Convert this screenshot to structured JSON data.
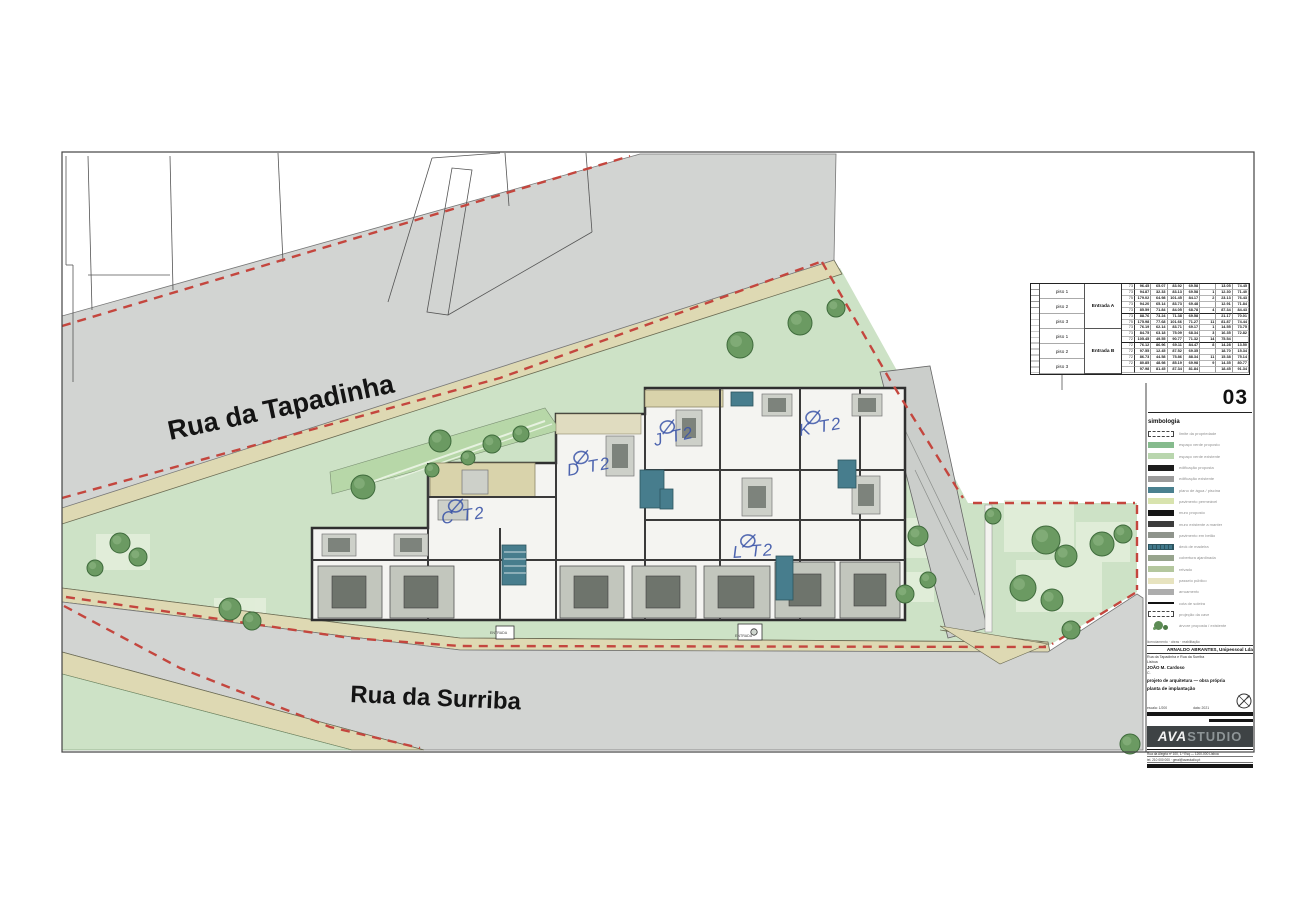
{
  "sheet": {
    "number": "03"
  },
  "streets": {
    "top": "Rua da Tapadinha",
    "bottom": "Rua da Surriba"
  },
  "plan": {
    "entrance_label": "ENTRADA",
    "unit_labels": [
      {
        "id": "C",
        "label": "C T2"
      },
      {
        "id": "D",
        "label": "D T2"
      },
      {
        "id": "J",
        "label": "J T2"
      },
      {
        "id": "K",
        "label": "K T2"
      },
      {
        "id": "L",
        "label": "L T2"
      }
    ]
  },
  "areas_table": {
    "row_labels": [
      "piso 1",
      "piso 2",
      "piso 3",
      "piso 1",
      "piso 2",
      "piso 3"
    ],
    "entrances": [
      "Entrada A",
      "Entrada B"
    ],
    "values": [
      [
        "73",
        "96.45",
        "65.07",
        "83.92",
        "69.58",
        "",
        "13.05",
        "74.45"
      ],
      [
        "73",
        "94.87",
        "32.33",
        "83.13",
        "69.58",
        "1",
        "12.30",
        "71.40"
      ],
      [
        "75",
        "179.02",
        "64.98",
        "101.45",
        "84.17",
        "2",
        "23.13",
        "76.43"
      ],
      [
        "73",
        "94.20",
        "65.14",
        "83.73",
        "69.48",
        "",
        "12.91",
        "71.84"
      ],
      [
        "73",
        "85.59",
        "71.84",
        "84.05",
        "68.78",
        "4",
        "87.34",
        "84.43"
      ],
      [
        "73",
        "88.76",
        "73.24",
        "71.38",
        "69.58",
        "",
        "21.17",
        "70.01"
      ],
      [
        "75",
        "175.98",
        "77.68",
        "101.66",
        "71.27",
        "11",
        "81.87",
        "74.44"
      ],
      [
        "73",
        "76.19",
        "62.14",
        "83.71",
        "69.17",
        "1",
        "14.55",
        "73.75"
      ],
      [
        "73",
        "84.75",
        "63.18",
        "75.09",
        "68.34",
        "3",
        "16.35",
        "72.82"
      ],
      [
        "72",
        "105.45",
        "49.55",
        "90.77",
        "71.32",
        "14",
        "75.54",
        ""
      ],
      [
        "72",
        "76.12",
        "86.96",
        "69.11",
        "84.47",
        "8",
        "14.28",
        "13.50"
      ],
      [
        "72",
        "97.55",
        "12.45",
        "87.52",
        "69.35",
        "",
        "18.70",
        "15.34"
      ],
      [
        "72",
        "86.73",
        "44.58",
        "75.86",
        "88.34",
        "11",
        "15.38",
        "75.14"
      ],
      [
        "72",
        "80.85",
        "48.98",
        "85.19",
        "69.98",
        "9",
        "14.35",
        "80.77"
      ],
      [
        "",
        "97.98",
        "81.45",
        "87.34",
        "81.84",
        "",
        "18.45",
        "91.34"
      ]
    ]
  },
  "legend": {
    "title": "simbologia",
    "items": [
      {
        "style": "dashed",
        "color": "#ffffff",
        "label": "limite da propriedade"
      },
      {
        "style": "solid",
        "color": "#86bb8d",
        "label": "espaço verde proposto"
      },
      {
        "style": "solid",
        "color": "#b9d6ae",
        "label": "espaço verde existente"
      },
      {
        "style": "solid",
        "color": "#1d1d1d",
        "label": "edificação proposta"
      },
      {
        "style": "solid",
        "color": "#9b9b9b",
        "label": "edificação existente"
      },
      {
        "style": "solid",
        "color": "#4a808f",
        "label": "plano de água / piscina"
      },
      {
        "style": "solid",
        "color": "#d8e3ae",
        "label": "pavimento permeável"
      },
      {
        "style": "solid",
        "color": "#161616",
        "label": "muro proposto"
      },
      {
        "style": "solid",
        "color": "#3c3c3c",
        "label": "muro existente a manter"
      },
      {
        "style": "solid",
        "color": "#8f948c",
        "label": "pavimento em betão"
      },
      {
        "style": "stripes",
        "color": "#41788a",
        "label": "deck de madeira"
      },
      {
        "style": "solid",
        "color": "#97a48d",
        "label": "cobertura ajardinada"
      },
      {
        "style": "solid",
        "color": "#b4c79e",
        "label": "relvado"
      },
      {
        "style": "solid",
        "color": "#e7e3bf",
        "label": "passeio público"
      },
      {
        "style": "solid",
        "color": "#adadad",
        "label": "arruamento"
      },
      {
        "style": "line",
        "color": "#111111",
        "label": "cota de soleira"
      },
      {
        "style": "dashed",
        "color": "#ffffff",
        "label": "projeção da cave"
      },
      {
        "style": "tree",
        "color": "#5d8c55",
        "label": "árvore proposta / existente"
      }
    ]
  },
  "title_block": {
    "top_note": "licenciamento · obras · reabilitação",
    "company": "ARNALDO ABRANTES, Unipessoal Lda",
    "address": "Rua da Tapadinha e Rua da Surriba",
    "locality": "Lisboa",
    "client": "JOÃO M. Cardoso",
    "ref": "C.",
    "project": "projeto de arquitetura — obra própria",
    "drawing": "planta de implantação",
    "scale_label": "escala: 1/200",
    "date_label": "data: 2021",
    "logo_ava": "AVA",
    "logo_studio": "STUDIO",
    "footer1": "Rua da Alegria nº 100, 1.º Esq — 1200-000 Lisboa",
    "footer2": "tel. 210 000 000 · geral@avastudio.pt"
  },
  "colors": {
    "street_gray": "#d2d4d2",
    "sidewalk": "#ded9b3",
    "verge_green": "#b7d7a8",
    "site_green": "#cde2c6",
    "garden_panel": "#e4efdc",
    "tree_green": "#6b9a62",
    "boundary_red": "#c4463e",
    "wall_dark": "#3a3a3a",
    "water_teal": "#477d8d",
    "roof_tan": "#d9d3ab",
    "ink_blue": "#3b55a8"
  }
}
